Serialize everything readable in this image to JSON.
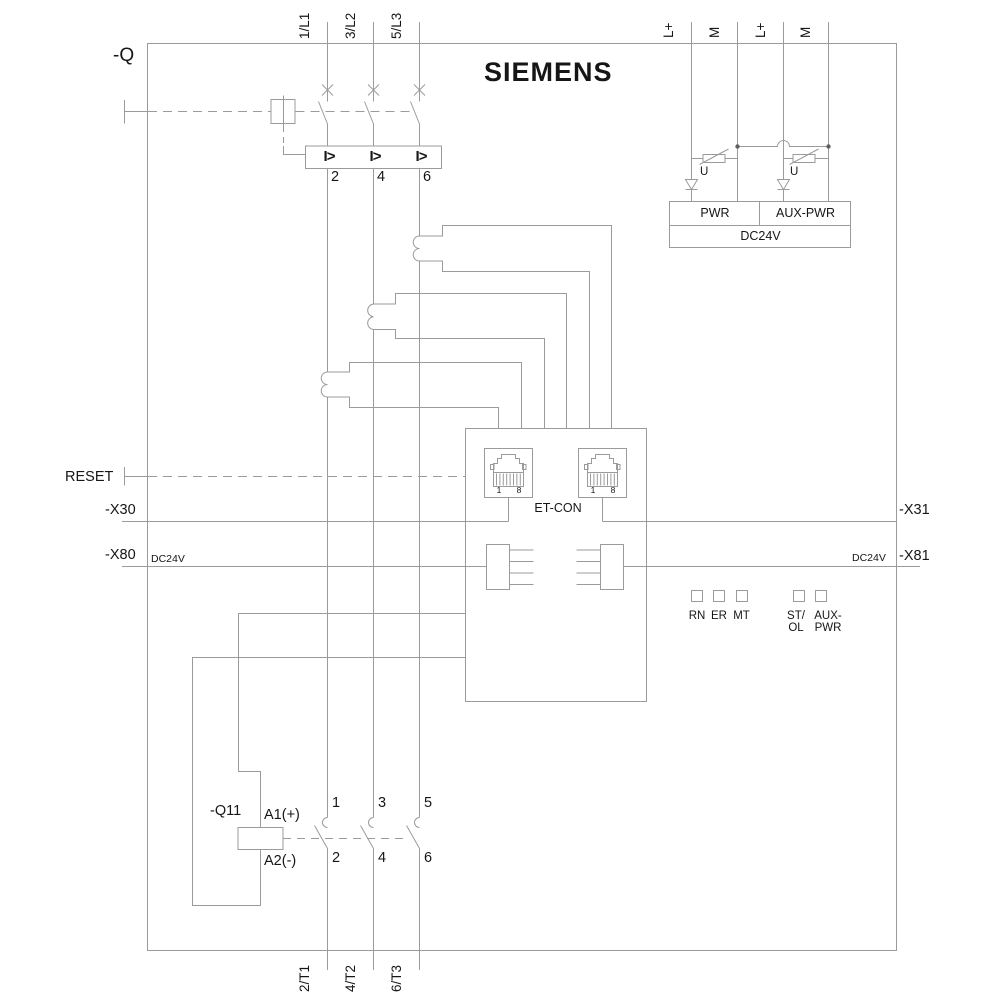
{
  "brand": "SIEMENS",
  "labels": {
    "device": "-Q",
    "reset": "RESET",
    "x30": "-X30",
    "x31": "-X31",
    "x80": "-X80",
    "x81": "-X81",
    "dc24v_left": "DC24V",
    "dc24v_right": "DC24V",
    "contactor": "-Q11",
    "coil_a1": "A1(+)",
    "coil_a2": "A2(-)"
  },
  "terminals": {
    "top": [
      "1/L1",
      "3/L2",
      "5/L3"
    ],
    "bottom": [
      "2/T1",
      "4/T2",
      "6/T3"
    ],
    "supply": [
      "L+",
      "M",
      "L+",
      "M"
    ]
  },
  "breaker": {
    "trip": "I>",
    "outputs": [
      "2",
      "4",
      "6"
    ]
  },
  "power": {
    "pwr": "PWR",
    "aux": "AUX-PWR",
    "dc": "DC24V",
    "u1": "U",
    "u2": "U"
  },
  "ethernet": {
    "label": "ET-CON",
    "pin1": "1",
    "pin8": "8"
  },
  "leds": {
    "rn": "RN",
    "er": "ER",
    "mt": "MT",
    "st": "ST/",
    "ol": "OL",
    "aux1": "AUX-",
    "aux2": "PWR"
  },
  "contactor_contacts": {
    "top": [
      "1",
      "3",
      "5"
    ],
    "bottom": [
      "2",
      "4",
      "6"
    ]
  },
  "colors": {
    "line": "#9b9b9b",
    "text": "#161616"
  }
}
